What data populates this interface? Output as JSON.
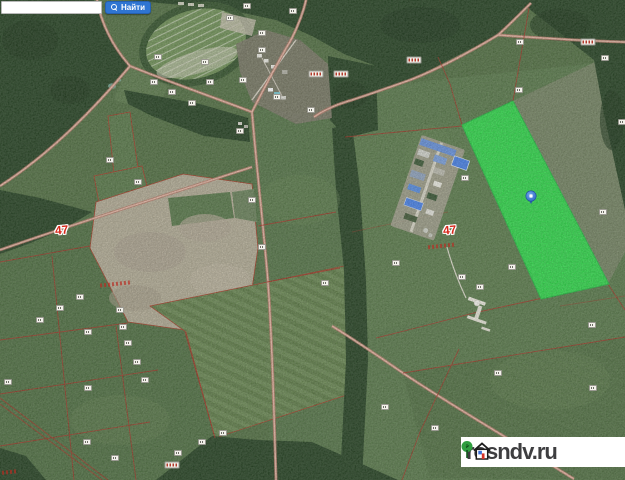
{
  "app": {
    "type": "satellite-cadastral-map"
  },
  "search": {
    "input_value": "",
    "button_label": "Найти"
  },
  "map_labels": {
    "region_codes": [
      {
        "text": "47",
        "x": 55,
        "y": 224
      },
      {
        "text": "47",
        "x": 443,
        "y": 224
      }
    ]
  },
  "marker": {
    "x": 531,
    "y": 196,
    "color": "#3e7cd6"
  },
  "highlighted_parcel": {
    "color": "#35e052",
    "points": "462,125 513,101 609,284 541,299"
  },
  "watermark": {
    "text": "rosndv.ru"
  },
  "colors": {
    "accent_blue": "#2f75d2",
    "highlight_green": "#35e052",
    "boundary_red": "#a8392b",
    "road_pink": "#e7bba9",
    "forest_green": "#2e4a2b",
    "field_green": "#587549",
    "bare_soil_tan": "#b9b19c"
  },
  "chips": [
    {
      "x": 158,
      "y": 57,
      "k": "w"
    },
    {
      "x": 154,
      "y": 82,
      "k": "w"
    },
    {
      "x": 172,
      "y": 92,
      "k": "w"
    },
    {
      "x": 192,
      "y": 103,
      "k": "w"
    },
    {
      "x": 247,
      "y": 6,
      "k": "w"
    },
    {
      "x": 230,
      "y": 18,
      "k": "w"
    },
    {
      "x": 262,
      "y": 33,
      "k": "w"
    },
    {
      "x": 262,
      "y": 50,
      "k": "w"
    },
    {
      "x": 277,
      "y": 97,
      "k": "w"
    },
    {
      "x": 293,
      "y": 11,
      "k": "w"
    },
    {
      "x": 311,
      "y": 110,
      "k": "w"
    },
    {
      "x": 205,
      "y": 62,
      "k": "w"
    },
    {
      "x": 210,
      "y": 82,
      "k": "w"
    },
    {
      "x": 243,
      "y": 80,
      "k": "w"
    },
    {
      "x": 138,
      "y": 182,
      "k": "w"
    },
    {
      "x": 110,
      "y": 160,
      "k": "w"
    },
    {
      "x": 240,
      "y": 131,
      "k": "w"
    },
    {
      "x": 252,
      "y": 200,
      "k": "w"
    },
    {
      "x": 262,
      "y": 247,
      "k": "w"
    },
    {
      "x": 325,
      "y": 283,
      "k": "w"
    },
    {
      "x": 396,
      "y": 263,
      "k": "w"
    },
    {
      "x": 520,
      "y": 42,
      "k": "w"
    },
    {
      "x": 605,
      "y": 58,
      "k": "w"
    },
    {
      "x": 519,
      "y": 90,
      "k": "w"
    },
    {
      "x": 465,
      "y": 178,
      "k": "w"
    },
    {
      "x": 622,
      "y": 122,
      "k": "w"
    },
    {
      "x": 603,
      "y": 212,
      "k": "w"
    },
    {
      "x": 512,
      "y": 267,
      "k": "w"
    },
    {
      "x": 480,
      "y": 287,
      "k": "w"
    },
    {
      "x": 462,
      "y": 277,
      "k": "w"
    },
    {
      "x": 498,
      "y": 373,
      "k": "w"
    },
    {
      "x": 592,
      "y": 325,
      "k": "w"
    },
    {
      "x": 593,
      "y": 388,
      "k": "w"
    },
    {
      "x": 385,
      "y": 407,
      "k": "w"
    },
    {
      "x": 435,
      "y": 428,
      "k": "w"
    },
    {
      "x": 80,
      "y": 297,
      "k": "w"
    },
    {
      "x": 60,
      "y": 308,
      "k": "w"
    },
    {
      "x": 40,
      "y": 320,
      "k": "w"
    },
    {
      "x": 88,
      "y": 332,
      "k": "w"
    },
    {
      "x": 120,
      "y": 310,
      "k": "w"
    },
    {
      "x": 123,
      "y": 327,
      "k": "w"
    },
    {
      "x": 128,
      "y": 343,
      "k": "w"
    },
    {
      "x": 137,
      "y": 362,
      "k": "w"
    },
    {
      "x": 145,
      "y": 380,
      "k": "w"
    },
    {
      "x": 88,
      "y": 388,
      "k": "w"
    },
    {
      "x": 87,
      "y": 442,
      "k": "w"
    },
    {
      "x": 115,
      "y": 458,
      "k": "w"
    },
    {
      "x": 223,
      "y": 433,
      "k": "w"
    },
    {
      "x": 202,
      "y": 442,
      "k": "w"
    },
    {
      "x": 178,
      "y": 453,
      "k": "w"
    },
    {
      "x": 8,
      "y": 382,
      "k": "w"
    },
    {
      "x": 414,
      "y": 60,
      "k": "r"
    },
    {
      "x": 588,
      "y": 42,
      "k": "r"
    },
    {
      "x": 172,
      "y": 465,
      "k": "r"
    },
    {
      "x": 316,
      "y": 74,
      "k": "r"
    },
    {
      "x": 341,
      "y": 74,
      "k": "r"
    }
  ],
  "redmarks": [
    {
      "x": 100,
      "y": 284,
      "w": 30
    },
    {
      "x": 428,
      "y": 246,
      "w": 26
    },
    {
      "x": 2,
      "y": 472,
      "w": 16
    }
  ]
}
